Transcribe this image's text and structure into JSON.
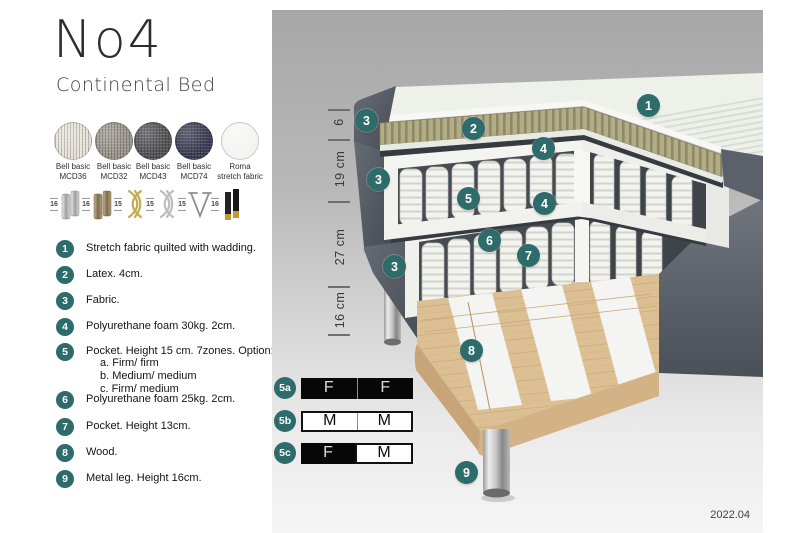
{
  "brand": {
    "title": "No4",
    "subtitle": "Continental Bed"
  },
  "fabrics": [
    {
      "name": "Bell basic",
      "code": "MCD36",
      "color": "#e7e3da"
    },
    {
      "name": "Bell basic",
      "code": "MCD32",
      "color": "#9a958d"
    },
    {
      "name": "Bell basic",
      "code": "MCD43",
      "color": "#545456"
    },
    {
      "name": "Bell basic",
      "code": "MCD74",
      "color": "#3b3e55"
    },
    {
      "name": "Roma",
      "code": "stretch fabric",
      "color": "#f3f3f1"
    }
  ],
  "legs": [
    {
      "height": "16",
      "style": "cylinder-silver"
    },
    {
      "height": "16",
      "style": "cylinder-bronze"
    },
    {
      "height": "15",
      "style": "twist-gold"
    },
    {
      "height": "15",
      "style": "twist-silver"
    },
    {
      "height": "15",
      "style": "hairpin"
    },
    {
      "height": "16",
      "style": "black-gold"
    }
  ],
  "features": [
    {
      "num": "1",
      "text": "Stretch fabric quilted with wadding."
    },
    {
      "num": "2",
      "text": "Latex. 4cm."
    },
    {
      "num": "3",
      "text": "Fabric."
    },
    {
      "num": "4",
      "text": "Polyurethane foam 30kg. 2cm."
    },
    {
      "num": "5",
      "text": "Pocket. Height 15 cm. 7zones. Option:",
      "options": [
        "a. Firm/ firm",
        "b. Medium/ medium",
        "c. Firm/ medium"
      ]
    },
    {
      "num": "6",
      "text": "Polyurethane foam 25kg. 2cm."
    },
    {
      "num": "7",
      "text": "Pocket. Height 13cm."
    },
    {
      "num": "8",
      "text": "Wood."
    },
    {
      "num": "9",
      "text": "Metal leg. Height 16cm."
    }
  ],
  "diagram": {
    "dimensions": [
      {
        "label": "6"
      },
      {
        "label": "19 cm"
      },
      {
        "label": "27 cm"
      },
      {
        "label": "16 cm"
      }
    ],
    "callouts": [
      {
        "n": "1"
      },
      {
        "n": "2"
      },
      {
        "n": "3"
      },
      {
        "n": "4"
      },
      {
        "n": "3"
      },
      {
        "n": "5"
      },
      {
        "n": "4"
      },
      {
        "n": "6"
      },
      {
        "n": "7"
      },
      {
        "n": "3"
      },
      {
        "n": "8"
      },
      {
        "n": "9"
      }
    ],
    "firmness": [
      {
        "label": "5a",
        "cells": [
          {
            "text": "F",
            "variant": "dark"
          },
          {
            "text": "F",
            "variant": "dark"
          }
        ]
      },
      {
        "label": "5b",
        "cells": [
          {
            "text": "M",
            "variant": "light"
          },
          {
            "text": "M",
            "variant": "light"
          }
        ]
      },
      {
        "label": "5c",
        "cells": [
          {
            "text": "F",
            "variant": "dark"
          },
          {
            "text": "M",
            "variant": "light"
          }
        ]
      }
    ],
    "version": "2022.04"
  },
  "colors": {
    "accent": "#2e6b6b",
    "latex": "#b2ad87",
    "wood": "#dcc094",
    "fabric_dark": "#565b63",
    "panel_top": "#a7a7a7",
    "panel_bottom": "#f5f5f5"
  }
}
